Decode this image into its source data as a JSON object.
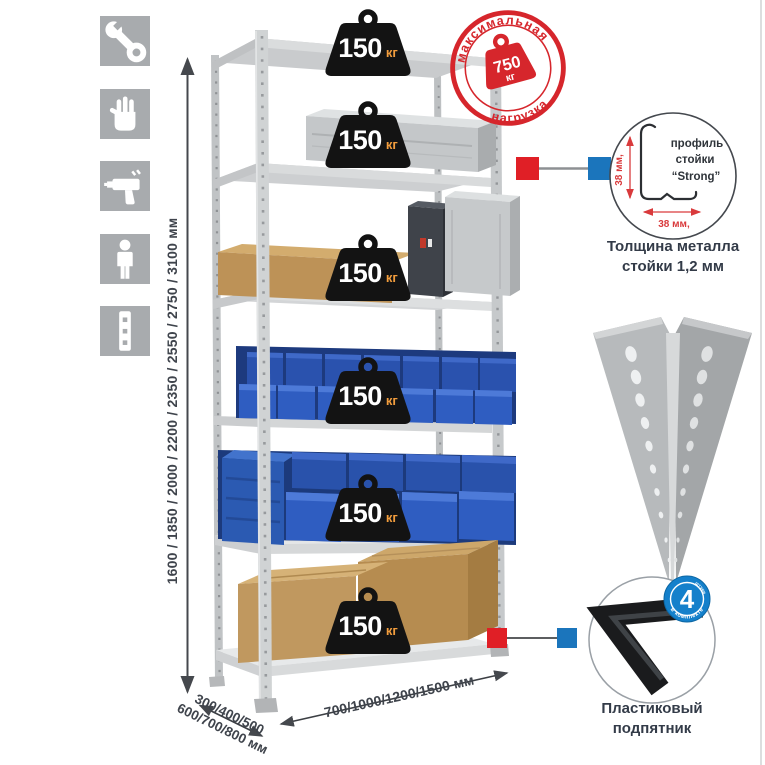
{
  "sidebar": {
    "icons": [
      {
        "name": "wrench"
      },
      {
        "name": "gloves"
      },
      {
        "name": "drill"
      },
      {
        "name": "person"
      },
      {
        "name": "upright-strip"
      }
    ]
  },
  "dimensions": {
    "height_label": "1600 / 1850 / 2000 / 2200 / 2350 / 2550 / 2750 / 3100 мм",
    "depth_label_line1": "300/400/500",
    "depth_label_line2": "600/700/800 мм",
    "width_label": "700/1000/1200/1500 мм"
  },
  "shelf_badges": [
    {
      "value": "150",
      "unit": "кг"
    },
    {
      "value": "150",
      "unit": "кг"
    },
    {
      "value": "150",
      "unit": "кг"
    },
    {
      "value": "150",
      "unit": "кг"
    },
    {
      "value": "150",
      "unit": "кг"
    },
    {
      "value": "150",
      "unit": "кг"
    }
  ],
  "stamp": {
    "arc_top": "максимальная",
    "arc_bottom": "нагрузка",
    "weight_value": "750",
    "weight_unit": "кг"
  },
  "profile_detail": {
    "label_line1": "профиль",
    "label_line2": "стойки",
    "label_line3": "“Strong”",
    "dim_vertical": "38 мм,",
    "dim_horizontal": "38 мм,",
    "caption_line1": "Толщина металла",
    "caption_line2": "стойки 1,2 мм"
  },
  "foot_detail": {
    "badge_number": "4",
    "badge_arc_top": "штуки",
    "badge_arc_bottom": "в комплекте",
    "caption_line1": "Пластиковый",
    "caption_line2": "подпятник"
  },
  "colors": {
    "accent_red": "#d6262c",
    "accent_blue": "#1b75bc",
    "badge_blue": "#1480cb",
    "kg_orange": "#f29d3d",
    "bin_blue": "#2f5dc1",
    "cardboard": "#c0985f",
    "metal_gray": "#c8cbcc",
    "text_dark": "#3a414c"
  }
}
